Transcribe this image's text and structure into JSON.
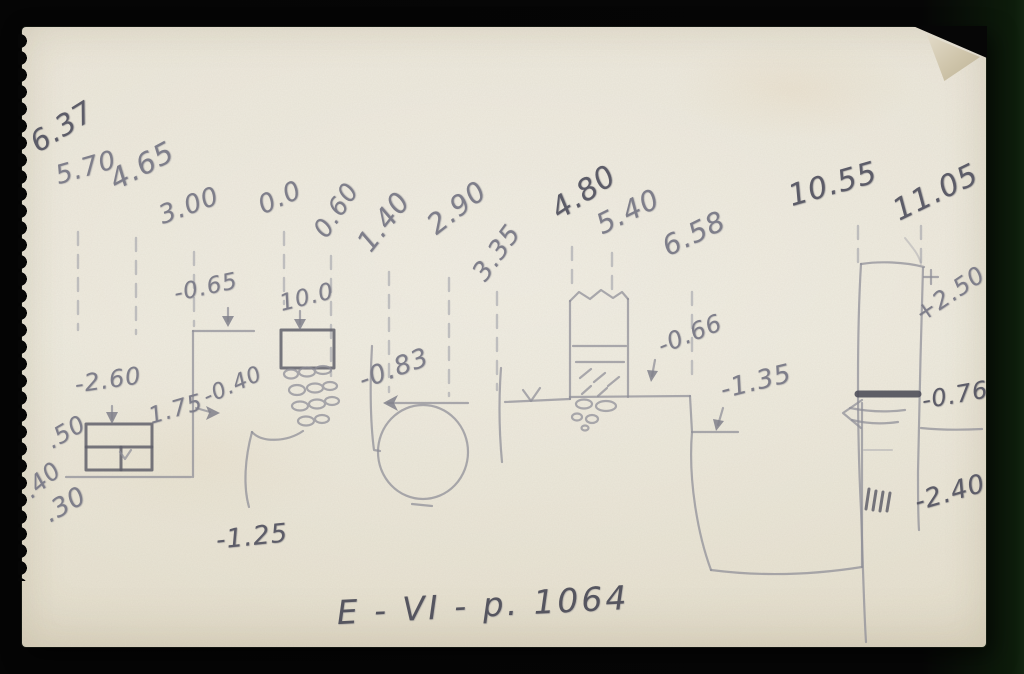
{
  "card": {
    "caption": "E - VI - p. 1064"
  },
  "colors": {
    "background": "#060606",
    "paper": "#eae5d7",
    "pencil": "#7e7e8a",
    "pencil_dark": "#5c5c68"
  },
  "elevation_labels": [
    "6.37",
    "5.70",
    "4.65",
    "3.00",
    "0.0",
    "0.60",
    "1.40",
    "2.90",
    "3.35",
    "4.80",
    "5.40",
    "6.58",
    "10.55",
    "11.05"
  ],
  "measurement_labels": [
    "-0.65",
    "10.0",
    "-2.60",
    "1.75",
    "-0.40",
    ".50",
    ".40",
    ".30",
    "-0.83",
    "-1.25",
    "-0.66",
    "-1.35",
    "+2.50",
    "-0.76",
    "-2.40"
  ]
}
